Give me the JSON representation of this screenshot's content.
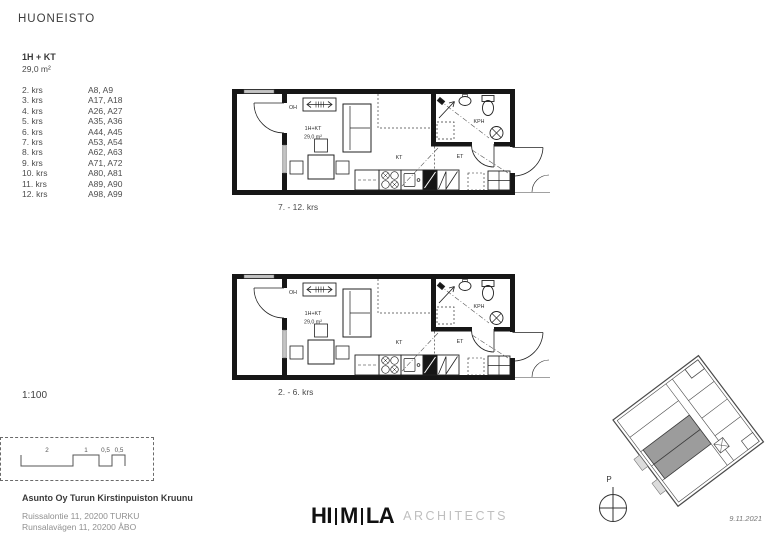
{
  "page": {
    "title": "HUONEISTO",
    "scale": "1:100",
    "date": "9.11.2021"
  },
  "apartment": {
    "type": "1H + KT",
    "area": "29,0 m²"
  },
  "floor_list": [
    {
      "floor": "2. krs",
      "units": "A8, A9"
    },
    {
      "floor": "3. krs",
      "units": "A17, A18"
    },
    {
      "floor": "4. krs",
      "units": "A26, A27"
    },
    {
      "floor": "5. krs",
      "units": "A35, A36"
    },
    {
      "floor": "6. krs",
      "units": "A44, A45"
    },
    {
      "floor": "7. krs",
      "units": "A53, A54"
    },
    {
      "floor": "8. krs",
      "units": "A62, A63"
    },
    {
      "floor": "9. krs",
      "units": "A71, A72"
    },
    {
      "floor": "10. krs",
      "units": "A80, A81"
    },
    {
      "floor": "11. krs",
      "units": "A89, A90"
    },
    {
      "floor": "12. krs",
      "units": "A98, A99"
    }
  ],
  "plans": [
    {
      "caption": "7. - 12. krs",
      "labels": {
        "living": "OH",
        "type": "1H+KT",
        "area": "29,0 m²",
        "kitchen": "KT",
        "bathroom": "KPH",
        "entry": "ET"
      }
    },
    {
      "caption": "2. - 6. krs",
      "labels": {
        "living": "OH",
        "type": "1H+KT",
        "area": "29,0 m²",
        "kitchen": "KT",
        "bathroom": "KPH",
        "entry": "ET"
      }
    }
  ],
  "scale_bar": {
    "labels": [
      "2",
      "1",
      "0,5",
      "0,5"
    ]
  },
  "project": {
    "name": "Asunto Oy Turun Kirstinpuiston Kruunu",
    "address_line1": "Ruissalontie 11, 20200 TURKU",
    "address_line2": "Runsalavägen 11, 20200 ÅBO"
  },
  "logo": {
    "part1": "HI",
    "part2": "M",
    "part3": "LA",
    "suffix": "ARCHITECTS"
  },
  "site_plan": {
    "north_label": "P"
  },
  "colors": {
    "ink": "#161616",
    "muted": "#909090",
    "logo_gray": "#bfbfbf",
    "highlight": "#9c9c9c",
    "window": "#c4c4c4"
  }
}
